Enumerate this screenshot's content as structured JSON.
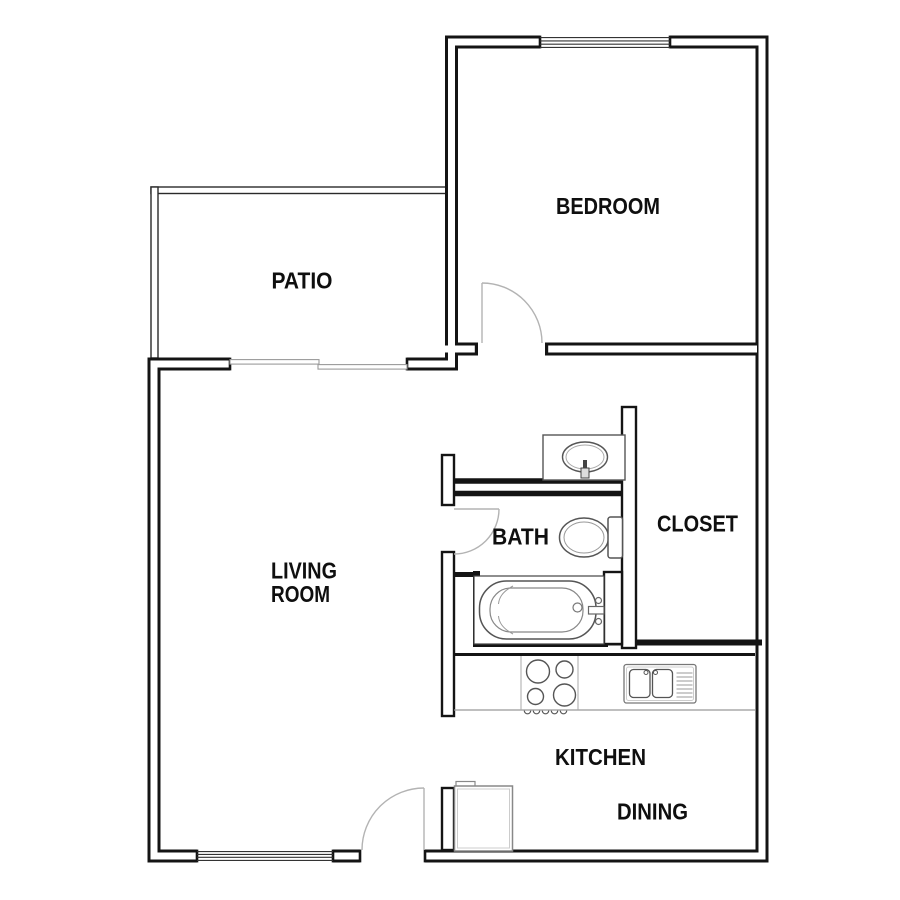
{
  "app": {
    "type": "apartment-floor-plan"
  },
  "rooms": {
    "bedroom": "BEDROOM",
    "patio": "PATIO",
    "living_line1": "LIVING",
    "living_line2": "ROOM",
    "bath": "BATH",
    "closet": "CLOSET",
    "kitchen": "KITCHEN",
    "dining": "DINING"
  },
  "fixtures": {
    "bathtub": "bathtub",
    "toilet": "toilet",
    "vanity_sink": "vanity-sink",
    "kitchen_sink": "double-kitchen-sink",
    "stove": "four-burner-stove",
    "water_heater": "water-heater",
    "windows": "window",
    "sliding_door": "sliding-glass-door",
    "swing_doors": "swing-door"
  },
  "colors": {
    "wall": "#141414",
    "door_swing": "#b3b3b3",
    "fixture": "#555555",
    "background": "#ffffff"
  }
}
